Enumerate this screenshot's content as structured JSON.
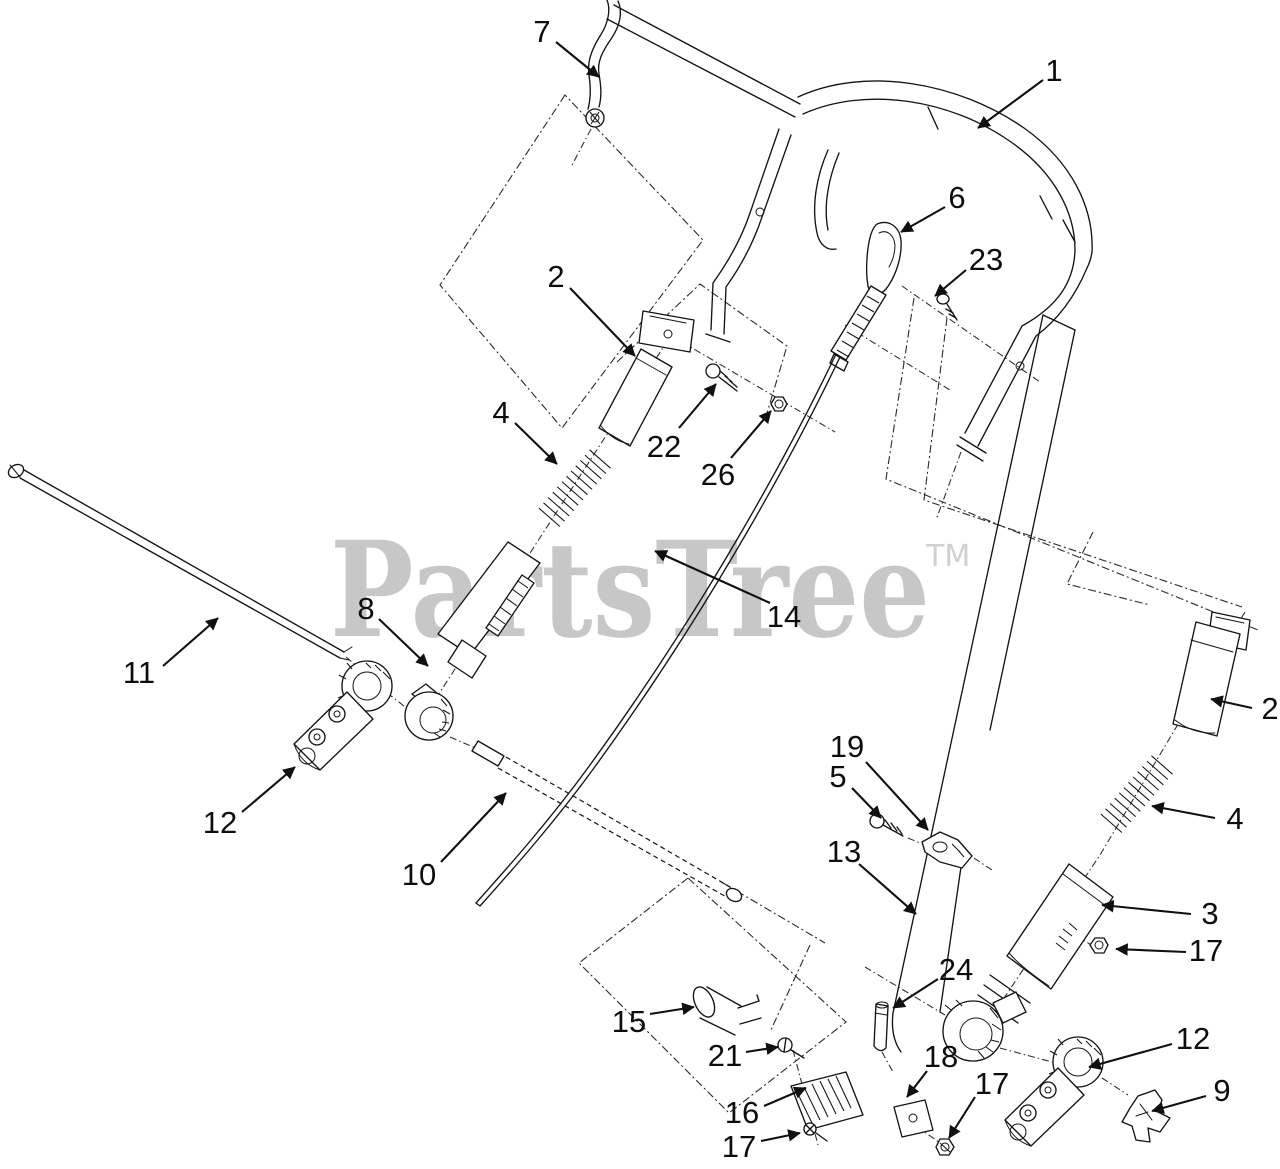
{
  "diagram": {
    "watermark": {
      "text": "PartsTree",
      "tm": "TM",
      "color": "#c7c7c7"
    },
    "line_color": "#141414",
    "background": "#ffffff",
    "callouts": [
      {
        "label": "7",
        "x": 542,
        "y": 31,
        "leader": [
          556,
          42,
          599,
          77
        ]
      },
      {
        "label": "1",
        "x": 1054,
        "y": 70,
        "leader": [
          1043,
          80,
          978,
          128
        ]
      },
      {
        "label": "6",
        "x": 957,
        "y": 197,
        "leader": [
          945,
          207,
          901,
          232
        ]
      },
      {
        "label": "23",
        "x": 986,
        "y": 259,
        "leader": [
          966,
          270,
          935,
          296
        ]
      },
      {
        "label": "2",
        "x": 556,
        "y": 276,
        "leader": [
          570,
          288,
          635,
          356
        ]
      },
      {
        "label": "22",
        "x": 664,
        "y": 446,
        "leader": [
          679,
          428,
          716,
          384
        ]
      },
      {
        "label": "26",
        "x": 718,
        "y": 474,
        "leader": [
          731,
          458,
          771,
          411
        ]
      },
      {
        "label": "4",
        "x": 501,
        "y": 412,
        "leader": [
          515,
          423,
          557,
          464
        ]
      },
      {
        "label": "14",
        "x": 784,
        "y": 616,
        "leader": [
          770,
          603,
          655,
          551
        ]
      },
      {
        "label": "8",
        "x": 366,
        "y": 608,
        "leader": [
          379,
          619,
          428,
          666
        ]
      },
      {
        "label": "11",
        "x": 139,
        "y": 672,
        "leader": [
          163,
          666,
          218,
          618
        ]
      },
      {
        "label": "12",
        "x": 220,
        "y": 822,
        "leader": [
          242,
          812,
          295,
          767
        ]
      },
      {
        "label": "10",
        "x": 419,
        "y": 874,
        "leader": [
          441,
          862,
          506,
          793
        ]
      },
      {
        "label": "13",
        "x": 844,
        "y": 851,
        "leader": [
          859,
          864,
          916,
          914
        ]
      },
      {
        "label": "19",
        "x": 847,
        "y": 746,
        "leader": [
          866,
          762,
          928,
          830
        ]
      },
      {
        "label": "5",
        "x": 838,
        "y": 776,
        "leader": [
          852,
          788,
          881,
          818
        ]
      },
      {
        "label": "3",
        "x": 1210,
        "y": 913,
        "leader": [
          1191,
          914,
          1102,
          905
        ]
      },
      {
        "label": "17",
        "x": 1206,
        "y": 950,
        "leader": [
          1186,
          952,
          1116,
          949
        ]
      },
      {
        "label": "2",
        "x": 1270,
        "y": 708,
        "leader": [
          1252,
          708,
          1211,
          699
        ]
      },
      {
        "label": "4",
        "x": 1235,
        "y": 818,
        "leader": [
          1215,
          818,
          1152,
          806
        ]
      },
      {
        "label": "15",
        "x": 629,
        "y": 1021,
        "leader": [
          650,
          1014,
          694,
          1007
        ]
      },
      {
        "label": "21",
        "x": 725,
        "y": 1055,
        "leader": [
          746,
          1052,
          778,
          1047
        ]
      },
      {
        "label": "16",
        "x": 742,
        "y": 1112,
        "leader": [
          764,
          1106,
          806,
          1088
        ]
      },
      {
        "label": "17",
        "x": 739,
        "y": 1146,
        "leader": [
          761,
          1141,
          800,
          1133
        ]
      },
      {
        "label": "24",
        "x": 956,
        "y": 969,
        "leader": [
          938,
          979,
          893,
          1008
        ]
      },
      {
        "label": "18",
        "x": 941,
        "y": 1056,
        "leader": [
          927,
          1071,
          907,
          1097
        ]
      },
      {
        "label": "17",
        "x": 992,
        "y": 1083,
        "leader": [
          975,
          1097,
          949,
          1138
        ]
      },
      {
        "label": "12",
        "x": 1193,
        "y": 1038,
        "leader": [
          1172,
          1044,
          1089,
          1067
        ]
      },
      {
        "label": "9",
        "x": 1222,
        "y": 1090,
        "leader": [
          1206,
          1096,
          1152,
          1111
        ]
      }
    ]
  }
}
